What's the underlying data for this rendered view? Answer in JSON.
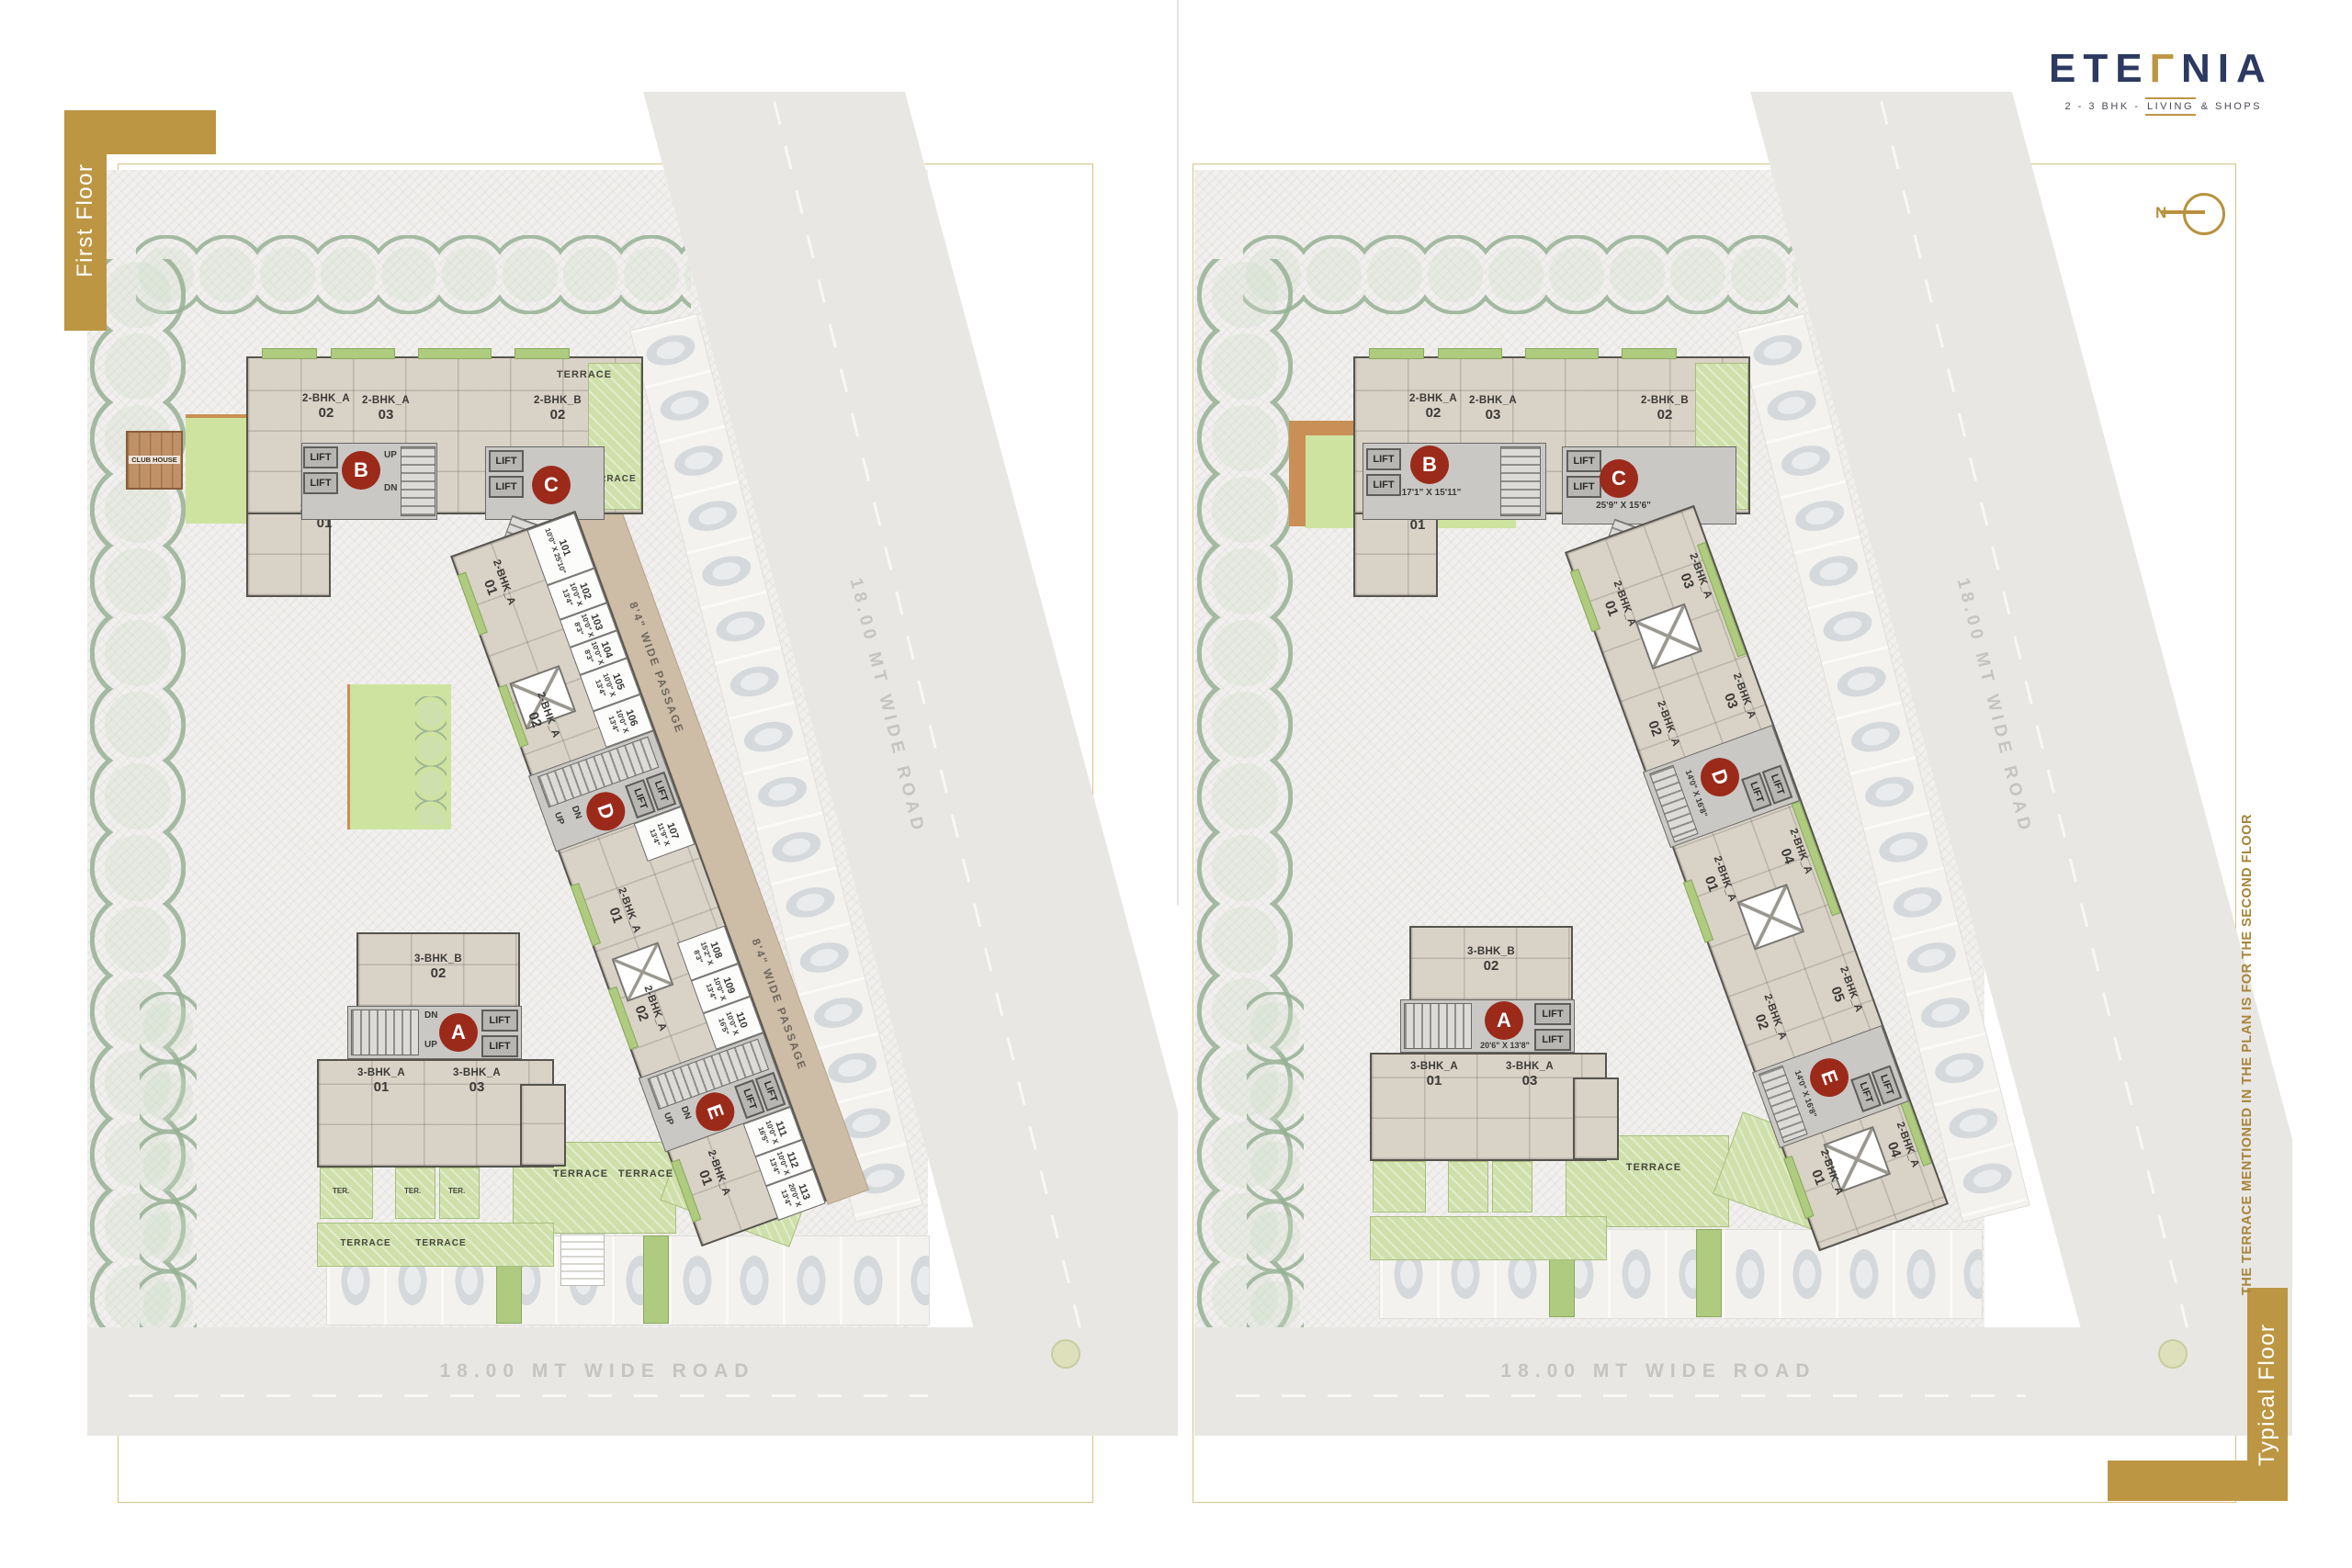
{
  "brand": {
    "logo_pre": "ETE",
    "logo_accent": "Γ",
    "logo_post": "NIA",
    "tagline_pre": "2 - 3 BHK - ",
    "tagline_living": "LIVING",
    "tagline_post": " & SHOPS"
  },
  "north_label": "N",
  "side_note": "THE TERRACE MENTIONED IN THE PLAN IS FOR THE SECOND FLOOR",
  "tabs": {
    "left": "First Floor",
    "right": "Typical Floor"
  },
  "labels": {
    "lift": "LIFT",
    "up": "UP",
    "dn": "DN",
    "terrace": "TERRACE",
    "ter": "TER.",
    "club_house": "CLUB HOUSE",
    "road": "18.00 MT WIDE ROAD",
    "passage": "8'4\" WIDE PASSAGE"
  },
  "blocks": {
    "a": "A",
    "b": "B",
    "c": "C",
    "d": "D",
    "e": "E"
  },
  "units": {
    "u2a": "2-BHK_A",
    "u2b": "2-BHK_B",
    "u3a": "3-BHK_A",
    "u3b": "3-BHK_B"
  },
  "nums": {
    "n01": "01",
    "n02": "02",
    "n03": "03",
    "n04": "04",
    "n05": "05"
  },
  "dims": {
    "a": "20'6\" X 13'8\"",
    "b": "17'1\" X 15'11\"",
    "c": "25'9\" X 15'6\"",
    "d": "14'0\" X 16'8\"",
    "e": "14'0\" X 16'8\""
  },
  "shops": [
    {
      "no": "101",
      "dim": "10'0\" X 25'10\""
    },
    {
      "no": "102",
      "dim": "10'0\" X 13'4\""
    },
    {
      "no": "103",
      "dim": "10'0\" X 8'3\""
    },
    {
      "no": "104",
      "dim": "10'0\" X 8'3\""
    },
    {
      "no": "105",
      "dim": "10'0\" X 13'4\""
    },
    {
      "no": "106",
      "dim": "10'0\" X 13'4\""
    },
    {
      "no": "107",
      "dim": "11'9\" X 13'4\""
    },
    {
      "no": "108",
      "dim": "15'2\" X 8'3\""
    },
    {
      "no": "109",
      "dim": "10'0\" X 13'4\""
    },
    {
      "no": "110",
      "dim": "10'0\" X 16'5\""
    },
    {
      "no": "111",
      "dim": "10'0\" X 16'5\""
    },
    {
      "no": "112",
      "dim": "10'0\" X 13'4\""
    },
    {
      "no": "113",
      "dim": "20'0\" X 13'4\""
    }
  ]
}
